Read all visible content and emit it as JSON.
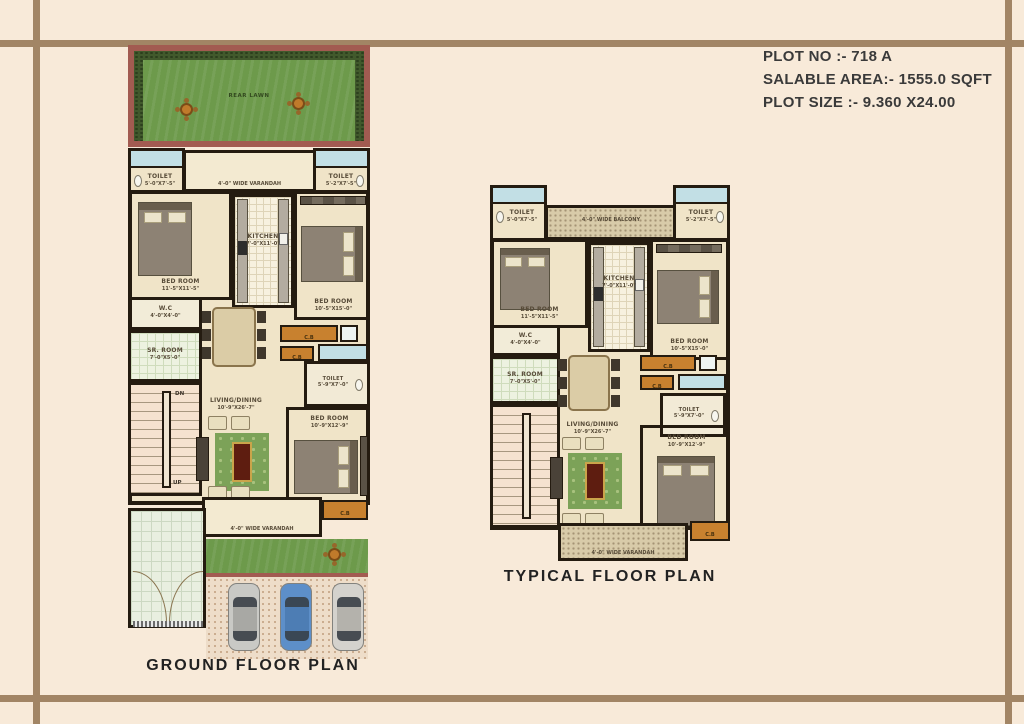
{
  "header": {
    "plot_no": "PLOT NO :- 718 A",
    "salable_area": "SALABLE AREA:- 1555.0 SQFT",
    "plot_size": "PLOT SIZE :- 9.360 X24.00"
  },
  "colors": {
    "frame": "#a28565",
    "lawn_green": "#6d9a4b",
    "cupboard_orange": "#c8812f",
    "car_blue": "#5d8fc9",
    "wall": "#241b10"
  },
  "ground": {
    "title": "GROUND FLOOR PLAN",
    "rear_lawn": "REAR LAWN",
    "toilet_left_name": "TOILET",
    "toilet_left_dim": "5'-0\"X7'-5\"",
    "toilet_right_name": "TOILET",
    "toilet_right_dim": "5'-2\"X7'-5\"",
    "varandah_top": "4'-0\" WIDE VARANDAH",
    "bed1_name": "BED ROOM",
    "bed1_dim": "11'-5\"X11'-5\"",
    "kitchen_name": "KITCHEN",
    "kitchen_dim": "7'-0\"X11'-0\"",
    "bed2_name": "BED ROOM",
    "bed2_dim": "10'-5\"X15'-0\"",
    "wc_name": "W.C",
    "wc_dim": "4'-0\"X4'-0\"",
    "sr_name": "SR. ROOM",
    "sr_dim": "7'-0\"X5'-0\"",
    "dn": "DN",
    "up": "UP",
    "cb": "C.B",
    "toilet_mid_name": "TOILET",
    "toilet_mid_dim": "5'-9\"X7'-0\"",
    "living_name": "LIVING/DINING",
    "living_dim": "10'-9\"X26'-7\"",
    "bed3_name": "BED ROOM",
    "bed3_dim": "10'-9\"X12'-9\"",
    "varandah_bottom": "4'-0\" WIDE VARANDAH"
  },
  "typical": {
    "title": "TYPICAL FLOOR PLAN",
    "balcony_top": "4'-0\" WIDE BALCONY",
    "toilet_left_name": "TOILET",
    "toilet_left_dim": "5'-0\"X7'-5\"",
    "toilet_right_name": "TOILET",
    "toilet_right_dim": "5'-2\"X7'-5\"",
    "bed1_name": "BED ROOM",
    "bed1_dim": "11'-5\"X11'-5\"",
    "kitchen_name": "KITCHEN",
    "kitchen_dim": "7'-0\"X11'-0\"",
    "bed2_name": "BED ROOM",
    "bed2_dim": "10'-5\"X15'-0\"",
    "wc_name": "W.C",
    "wc_dim": "4'-0\"X4'-0\"",
    "sr_name": "SR. ROOM",
    "sr_dim": "7'-0\"X5'-0\"",
    "cb": "C.B",
    "toilet_mid_name": "TOILET",
    "toilet_mid_dim": "5'-9\"X7'-0\"",
    "living_name": "LIVING/DINING",
    "living_dim": "10'-9\"X26'-7\"",
    "bed3_name": "BED ROOM",
    "bed3_dim": "10'-9\"X12'-9\"",
    "varandah_bottom": "4'-0\" WIDE VARANDAH"
  }
}
